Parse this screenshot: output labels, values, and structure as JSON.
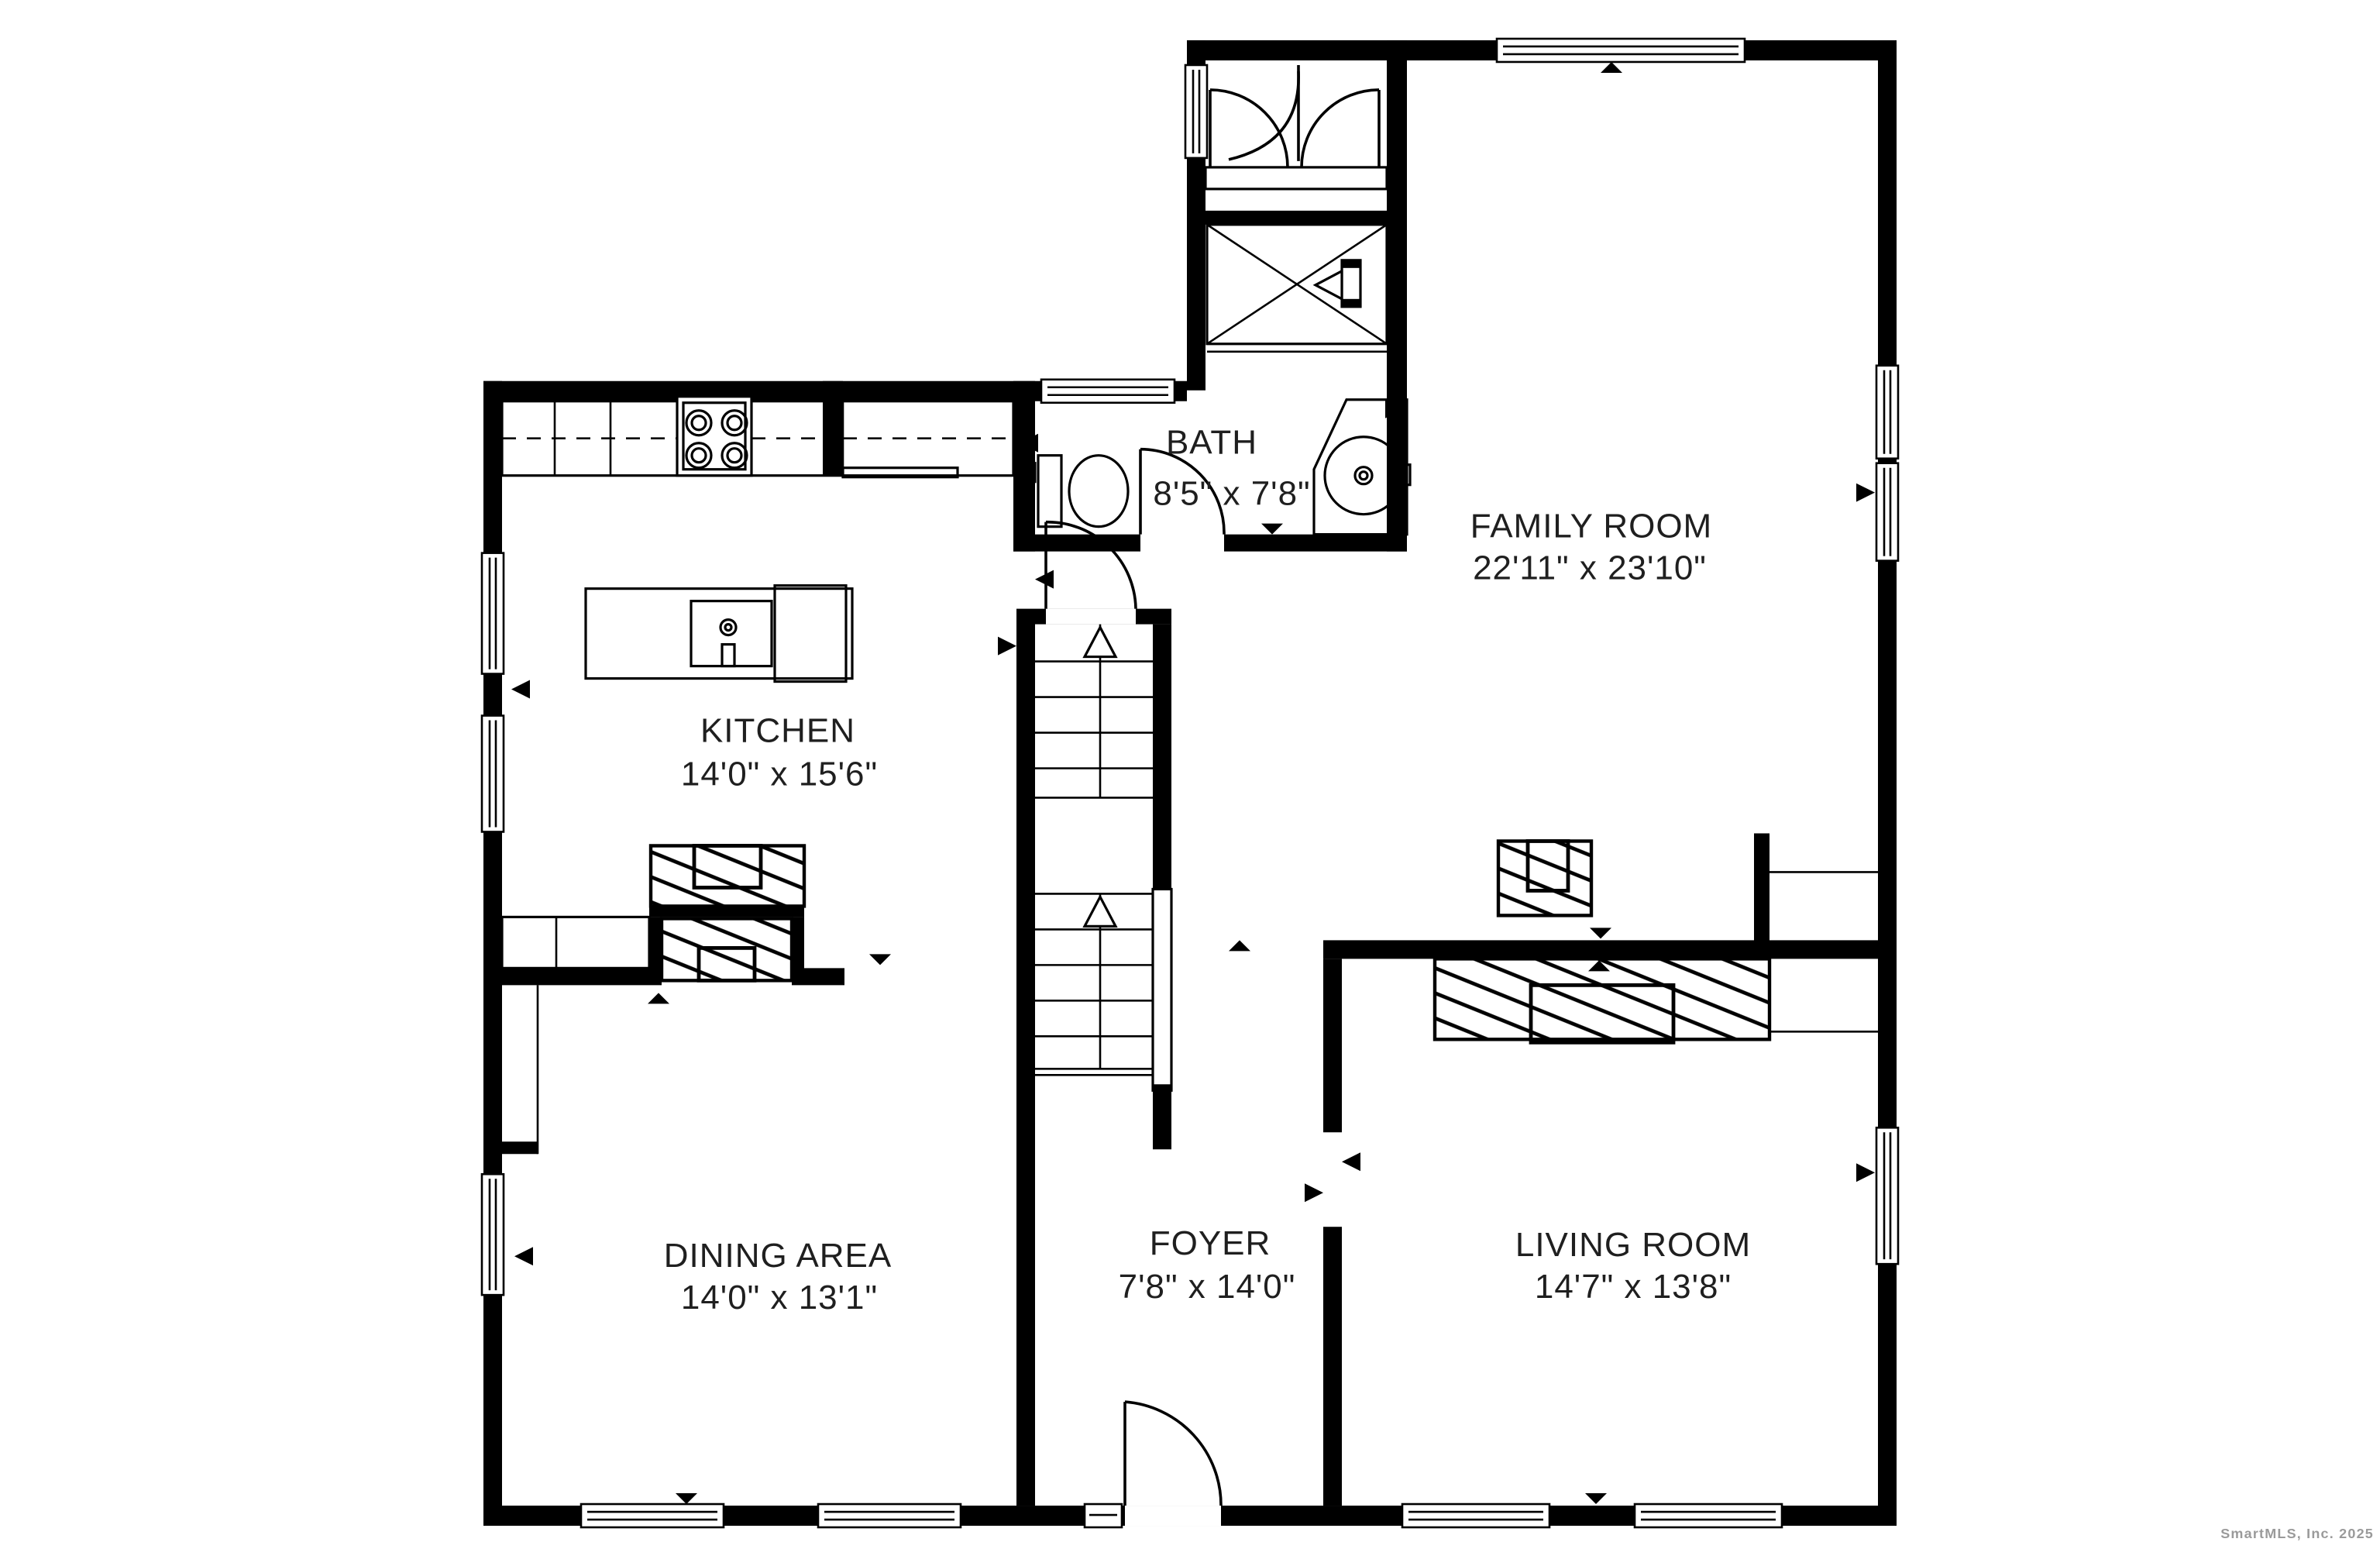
{
  "plan": {
    "type": "floor-plan",
    "background": "#ffffff",
    "wall_color": "#000000",
    "label_color": "#1f1f1f"
  },
  "rooms": [
    {
      "id": "bath",
      "name": "BATH",
      "dimensions": "8'5\" x 7'8\""
    },
    {
      "id": "family-room",
      "name": "FAMILY ROOM",
      "dimensions": "22'11\" x 23'10\""
    },
    {
      "id": "kitchen",
      "name": "KITCHEN",
      "dimensions": "14'0\" x 15'6\""
    },
    {
      "id": "dining-area",
      "name": "DINING AREA",
      "dimensions": "14'0\" x 13'1\""
    },
    {
      "id": "foyer",
      "name": "FOYER",
      "dimensions": "7'8\" x 14'0\""
    },
    {
      "id": "living-room",
      "name": "LIVING ROOM",
      "dimensions": "14'7\" x 13'8\""
    }
  ],
  "fixtures": [
    "stove-icon",
    "kitchen-island-sink-icon",
    "counter-icon",
    "toilet-icon",
    "bathroom-sink-icon",
    "shower-icon",
    "staircase-up-icon",
    "fireplace-hatch-icon",
    "door-swing-icon",
    "window-icon",
    "closet-double-door-icon",
    "opening-arrow-icon"
  ],
  "watermark": {
    "text": "SmartMLS, Inc.  2025",
    "color": "#9a9a9a"
  }
}
